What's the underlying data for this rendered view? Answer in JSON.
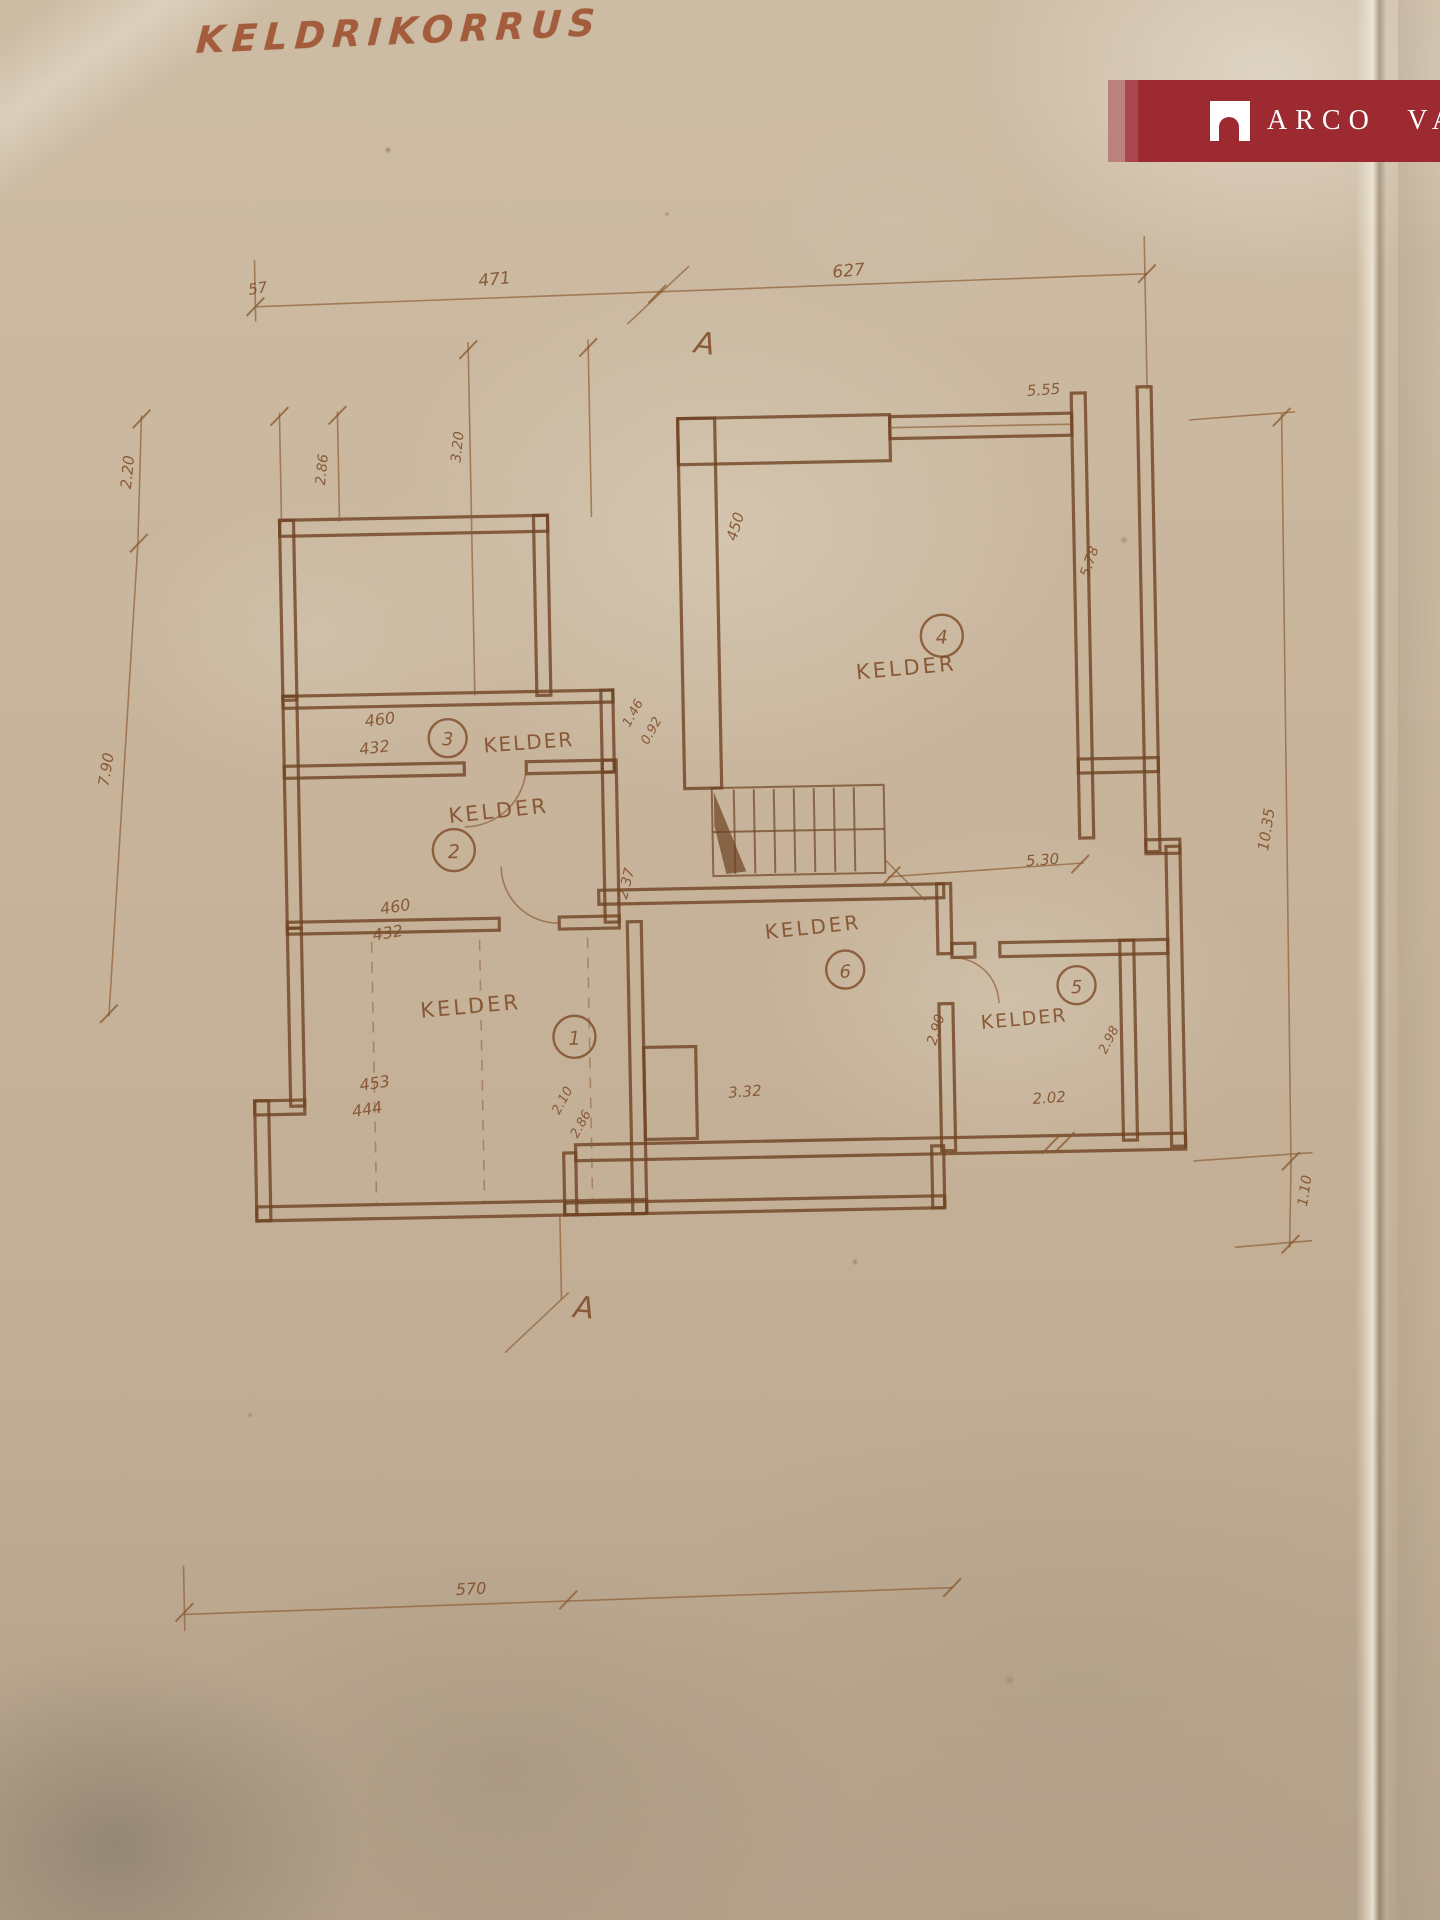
{
  "plan": {
    "title": "KELDRIKORRUS",
    "sections": {
      "top": "A",
      "bottom": "A"
    },
    "rooms": {
      "r1": {
        "number": "1",
        "name": "KELDER",
        "dim_a": "453",
        "dim_b": "444",
        "dim_c": "2.10",
        "dim_d": "2.86"
      },
      "r2": {
        "number": "2",
        "name": "KELDER",
        "dim_a": "460",
        "dim_b": "432",
        "dim_c": "2.37"
      },
      "r3": {
        "number": "3",
        "name": "KELDER",
        "dim_a": "460",
        "dim_b": "432",
        "dim_c": "1.46",
        "dim_d": "0.92"
      },
      "r4": {
        "number": "4",
        "name": "KELDER",
        "dim_a": "5.55",
        "dim_b": "5.78",
        "dim_c": "450"
      },
      "r5": {
        "number": "5",
        "name": "KELDER",
        "dim_a": "2.02",
        "dim_b": "2.98"
      },
      "r6": {
        "number": "6",
        "name": "KELDER",
        "dim_a": "3.32",
        "dim_b": "2.90",
        "dim_c": "5.30"
      }
    },
    "dimensions": {
      "top_small": "57",
      "top_left": "471",
      "top_right": "627",
      "left_upper": "2.20",
      "left_lower": "7.90",
      "ext_left": "2.86",
      "ext_mid": "3.20",
      "right_main": "10.35",
      "right_small": "1.10",
      "bottom": "570"
    }
  },
  "brand_badge": {
    "label": "ARCO VARA",
    "icon": "arch-logo-icon",
    "background_color": "#9D2931",
    "text_color": "#FFFFFF"
  },
  "paper_color": "#C6B49C",
  "ink_color": "#7D4A26"
}
